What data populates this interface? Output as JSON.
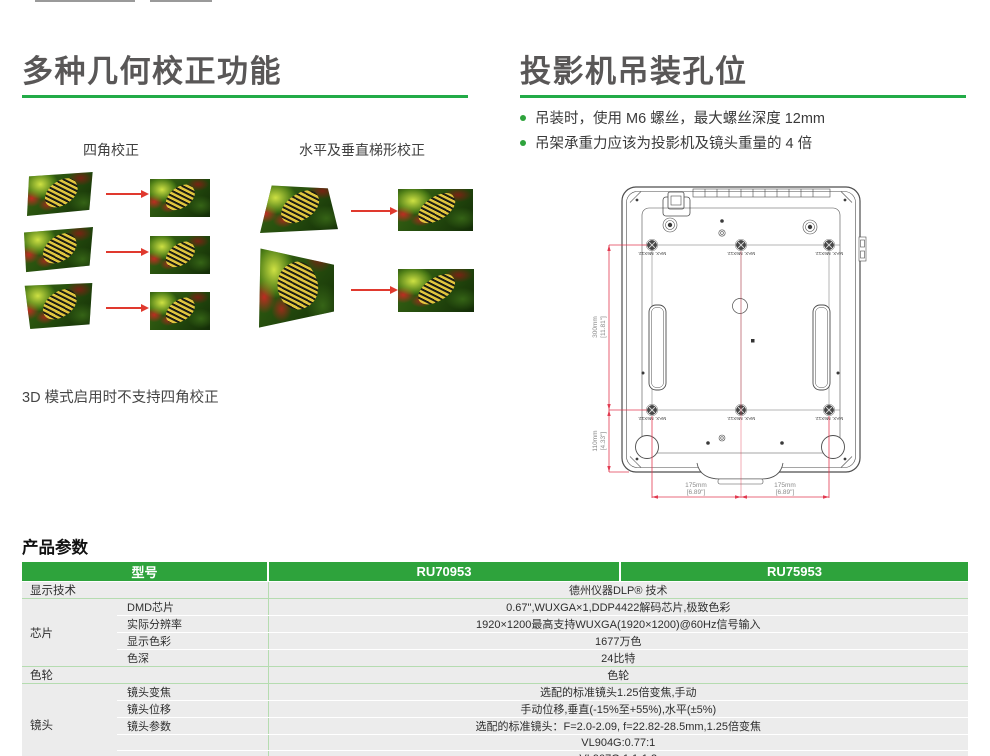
{
  "geometry_section": {
    "title": "多种几何校正功能",
    "four_corner_label": "四角校正",
    "keystone_label": "水平及垂直梯形校正",
    "note_3d": "3D 模式启用时不支持四角校正"
  },
  "mount_section": {
    "title": "投影机吊装孔位",
    "bullet_1": "吊装时，使用 M6 螺丝，最大螺丝深度 12mm",
    "bullet_2": "吊架承重力应该为投影机及镜头重量的 4 倍",
    "diagram": {
      "screw_label": "MAX. M6X12.",
      "dim_v1_mm": "300mm",
      "dim_v1_in": "[11.81\"]",
      "dim_v2_mm": "110mm",
      "dim_v2_in": "[4.33\"]",
      "dim_h_mm": "175mm",
      "dim_h_in": "[6.89\"]"
    }
  },
  "spec_section": {
    "title": "产品参数",
    "header": {
      "model_label": "型号",
      "model_1": "RU70953",
      "model_2": "RU75953"
    },
    "display_tech": {
      "label": "显示技术",
      "value": "德州仪器DLP® 技术"
    },
    "chip_group": {
      "label": "芯片",
      "rows": [
        {
          "sub": "DMD芯片",
          "value": "0.67\",WUXGA×1,DDP4422解码芯片,极致色彩"
        },
        {
          "sub": "实际分辨率",
          "value": "1920×1200最高支持WUXGA(1920×1200)@60Hz信号输入"
        },
        {
          "sub": "显示色彩",
          "value": "1677万色"
        },
        {
          "sub": "色深",
          "value": "24比特"
        }
      ]
    },
    "color_wheel": {
      "label": "色轮",
      "value": "色轮"
    },
    "lens_group": {
      "label": "镜头",
      "rows": [
        {
          "sub": "镜头变焦",
          "value": "选配的标准镜头1.25倍变焦,手动"
        },
        {
          "sub": "镜头位移",
          "value": "手动位移,垂直(-15%至+55%),水平(±5%)"
        },
        {
          "sub": "镜头参数",
          "value": "选配的标准镜头：F=2.0-2.09, f=22.82-28.5mm,1.25倍变焦"
        },
        {
          "sub": "",
          "value": "VL904G:0.77:1"
        },
        {
          "sub": "",
          "value": "VL907G:1.1-1.3"
        }
      ]
    }
  },
  "colors": {
    "accent_green": "#22ab47",
    "table_header_green": "#2ea33c",
    "dimension_red": "#e23a50",
    "heading_gray": "#595757"
  }
}
